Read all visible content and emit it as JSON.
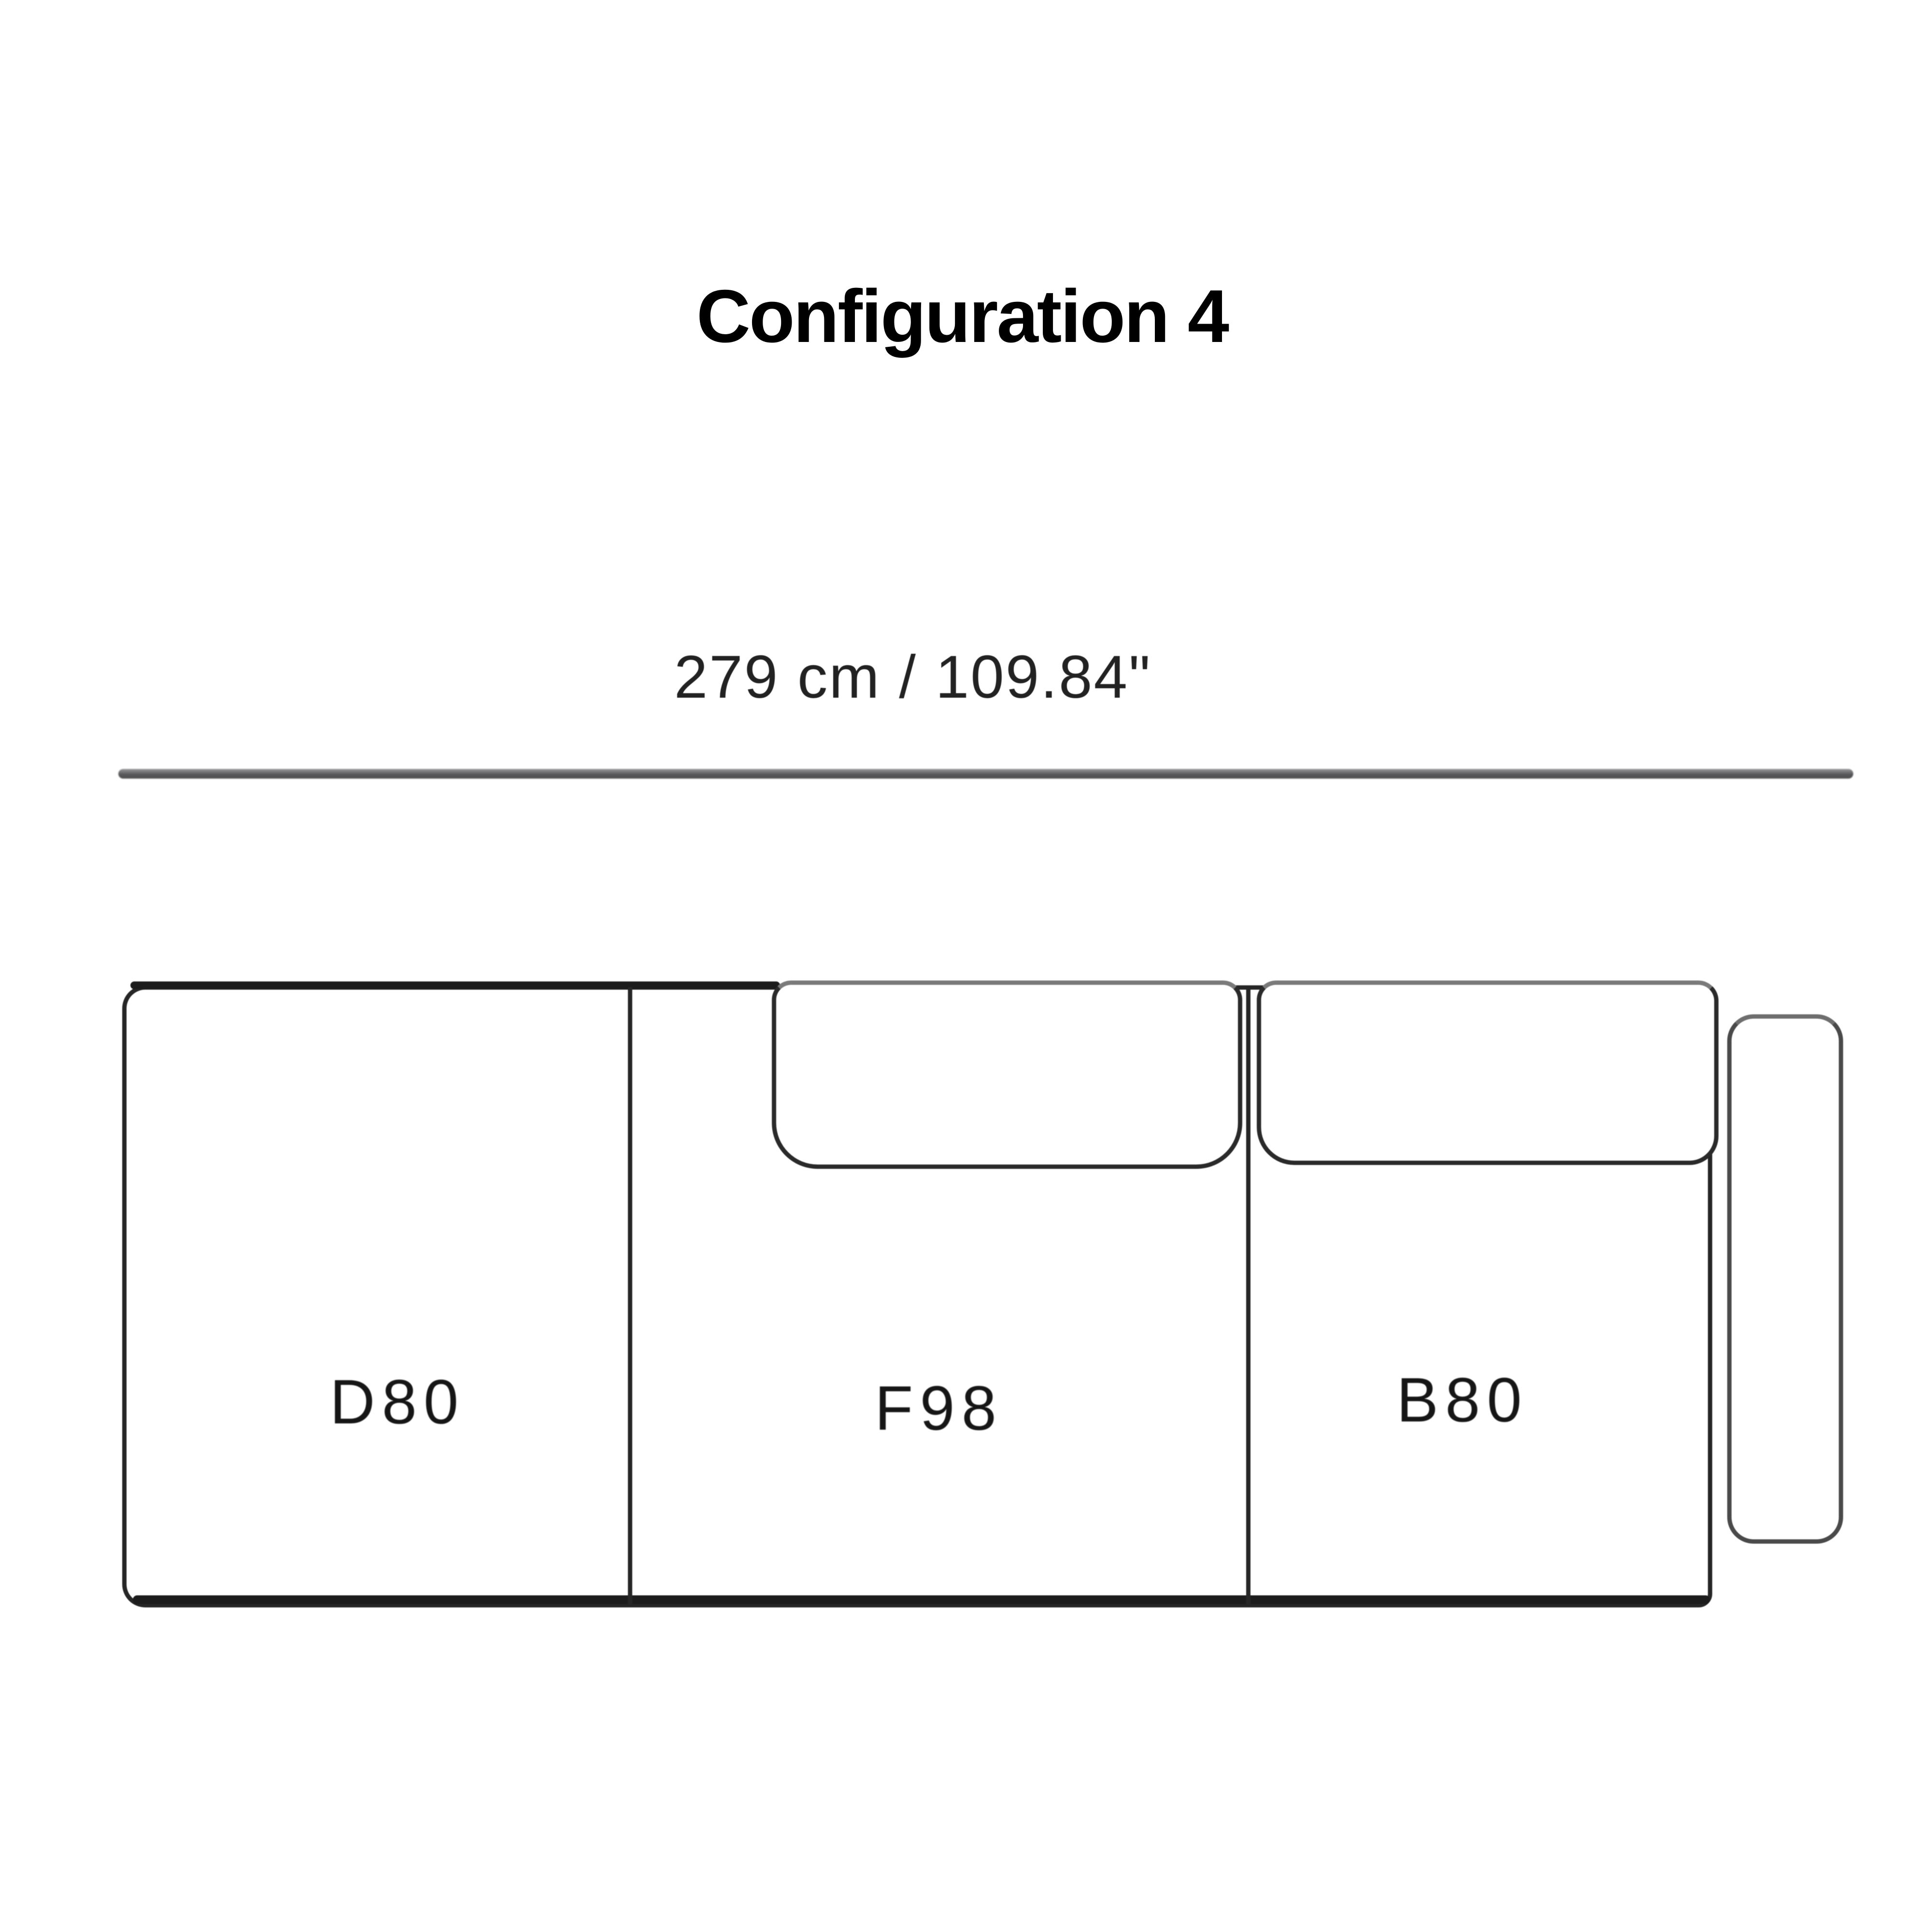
{
  "title": "Configuration 4",
  "dimension": {
    "total_label": "279 cm / 109.84\""
  },
  "sofa": {
    "modules": [
      {
        "code": "D80"
      },
      {
        "code": "F98"
      },
      {
        "code": "B80"
      }
    ],
    "armrest_side": "right"
  },
  "colors": {
    "outline": "#262626",
    "soft_line": "#6e6e6e",
    "dimension_line": "#58585a",
    "text": "#161616",
    "background": "#ffffff"
  }
}
